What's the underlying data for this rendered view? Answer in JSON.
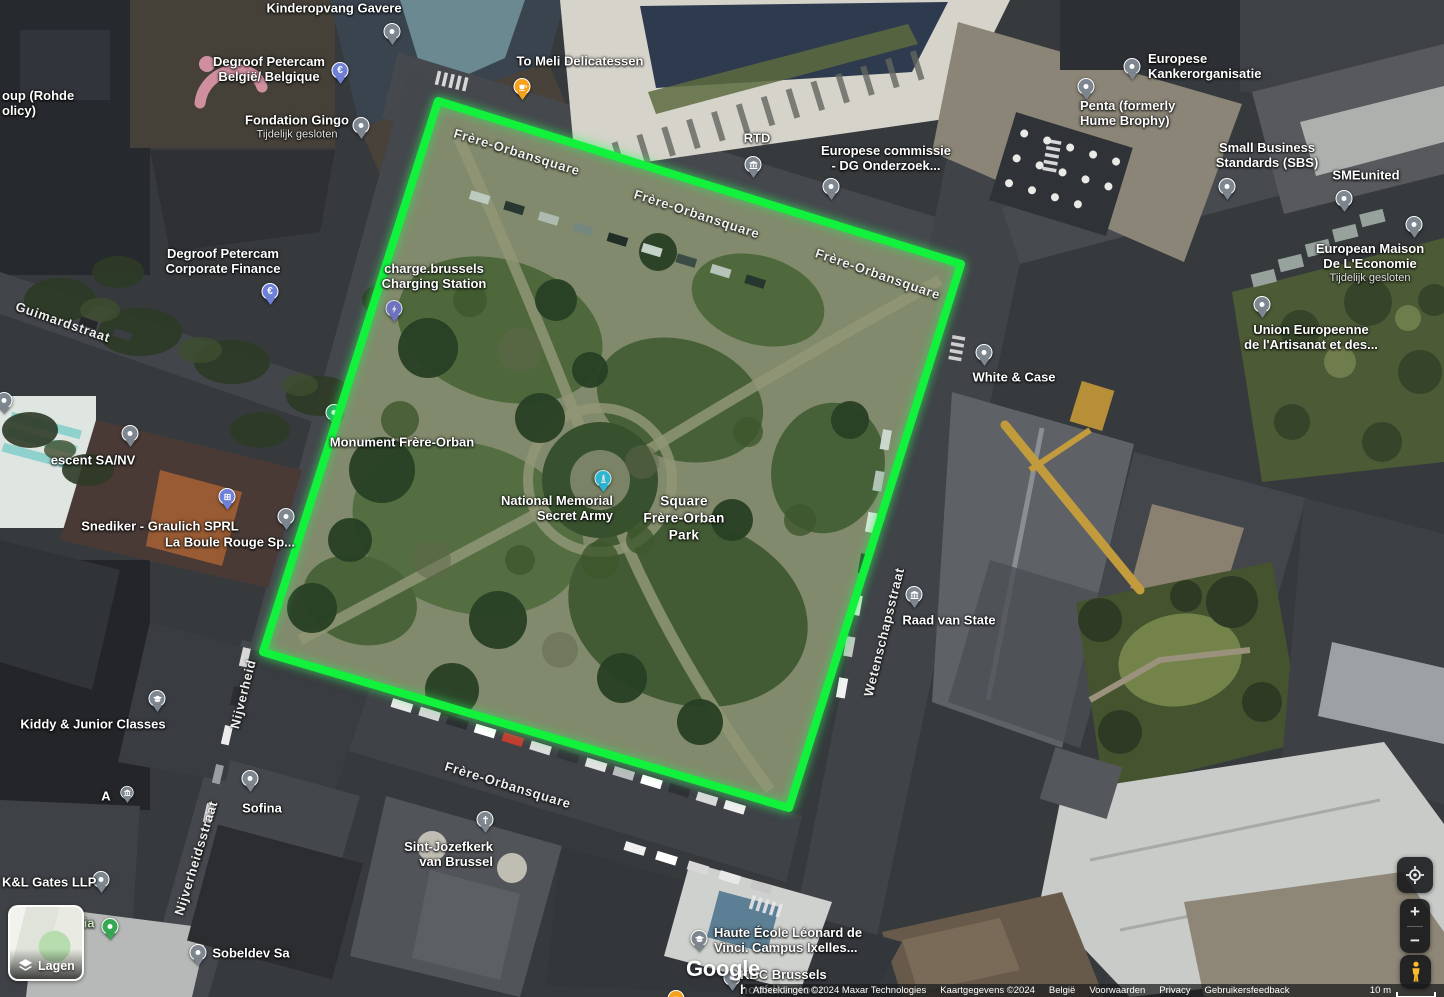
{
  "brand": "Google",
  "green_area": {
    "stroke": "#12f13c",
    "points": [
      [
        438,
        101
      ],
      [
        961,
        264
      ],
      [
        789,
        808
      ],
      [
        263,
        652
      ]
    ]
  },
  "pin_colors": {
    "dot": "#7E8790",
    "bank": "#7E8790",
    "gov": "#7E8790",
    "education": "#7E8790",
    "church": "#7E8790",
    "euro": "#6F80D8",
    "store": "#6F80D8",
    "charging": "#8174DE",
    "memorial": "#35C3F1",
    "monument": "#2AA465",
    "park": "#34A853",
    "food": "#F6A21D"
  },
  "street_labels": [
    {
      "text": "Frère-Orbansquare",
      "x": 517,
      "y": 152,
      "rot": 17
    },
    {
      "text": "Frère-Orbansquare",
      "x": 697,
      "y": 214,
      "rot": 18
    },
    {
      "text": "Frère-Orbansquare",
      "x": 878,
      "y": 274,
      "rot": 19
    },
    {
      "text": "Frère-Orbansquare",
      "x": 508,
      "y": 785,
      "rot": 17
    },
    {
      "text": "Guimardstraat",
      "x": 63,
      "y": 322,
      "rot": 19
    },
    {
      "text": "Wetenschapsstraat",
      "x": 884,
      "y": 632,
      "rot": -76
    },
    {
      "text": "Nijverheid",
      "x": 243,
      "y": 694,
      "rot": -76
    },
    {
      "text": "Nijverheidsstraat",
      "x": 196,
      "y": 858,
      "rot": -73
    }
  ],
  "markers": [
    {
      "id": "kinderopvang-gavere",
      "type": "dot",
      "x": 392,
      "y": 45,
      "lines": [
        "Kinderopvang Gavere"
      ],
      "lx": 334,
      "ly": 9,
      "align": "center"
    },
    {
      "id": "degroof-petercam-belgie",
      "type": "euro",
      "x": 340,
      "y": 84,
      "lines": [
        "Degroof Petercam",
        "België/ Belgique"
      ],
      "lx": 269,
      "ly": 70,
      "align": "center"
    },
    {
      "id": "fondation-gingo",
      "type": "dot",
      "x": 361,
      "y": 139,
      "lines": [
        "Fondation Gingo"
      ],
      "sub": "Tijdelijk gesloten",
      "lx": 297,
      "ly": 127,
      "align": "center"
    },
    {
      "id": "rohde-partial",
      "type": "none",
      "lines": [
        "oup (Rohde",
        "olicy)"
      ],
      "lx": 2,
      "ly": 104,
      "align": "left"
    },
    {
      "id": "degroof-petercam-corporate",
      "type": "euro",
      "x": 270,
      "y": 305,
      "lines": [
        "Degroof Petercam",
        "Corporate Finance"
      ],
      "lx": 223,
      "ly": 262,
      "align": "center"
    },
    {
      "id": "to-meli-delicatessen",
      "type": "food",
      "x": 522,
      "y": 100,
      "lines": [
        "To Meli Delicatessen"
      ],
      "lx": 580,
      "ly": 62,
      "align": "center"
    },
    {
      "id": "rtd",
      "type": "bank",
      "x": 753,
      "y": 178,
      "lines": [
        "RTD"
      ],
      "lx": 757,
      "ly": 139,
      "align": "center"
    },
    {
      "id": "europese-commissie",
      "type": "dot",
      "x": 831,
      "y": 200,
      "lines": [
        "Europese commissie",
        "- DG Onderzoek..."
      ],
      "lx": 886,
      "ly": 159,
      "align": "center"
    },
    {
      "id": "europese-kankerorganisatie",
      "type": "dot",
      "x": 1132,
      "y": 80,
      "lines": [
        "Europese",
        "Kankerorganisatie"
      ],
      "lx": 1148,
      "ly": 67,
      "align": "left"
    },
    {
      "id": "penta-hume-brophy",
      "type": "dot",
      "x": 1086,
      "y": 100,
      "lines": [
        "Penta (formerly",
        "Hume Brophy)"
      ],
      "lx": 1080,
      "ly": 114,
      "align": "left"
    },
    {
      "id": "small-business-standards",
      "type": "dot",
      "x": 1227,
      "y": 200,
      "lines": [
        "Small Business",
        "Standards (SBS)"
      ],
      "lx": 1267,
      "ly": 156,
      "align": "center"
    },
    {
      "id": "smeunited",
      "type": "dot",
      "x": 1344,
      "y": 212,
      "lines": [
        "SMEunited"
      ],
      "lx": 1366,
      "ly": 176,
      "align": "center"
    },
    {
      "id": "european-maison-economie",
      "type": "dot",
      "x": 1414,
      "y": 238,
      "lines": [
        "European Maison",
        "De L'Economie"
      ],
      "sub": "Tijdelijk gesloten",
      "lx": 1370,
      "ly": 263,
      "align": "center"
    },
    {
      "id": "union-europeenne-artisanat",
      "type": "dot",
      "x": 1262,
      "y": 318,
      "lines": [
        "Union Europeenne",
        "de l'Artisanat et des..."
      ],
      "lx": 1311,
      "ly": 338,
      "align": "center"
    },
    {
      "id": "charge-brussels",
      "type": "charging",
      "x": 394,
      "y": 322,
      "lines": [
        "charge.brussels",
        "Charging Station"
      ],
      "lx": 434,
      "ly": 277,
      "align": "center"
    },
    {
      "id": "monument-frere-orban",
      "type": "monument",
      "x": 334,
      "y": 426,
      "lines": [
        "Monument Frère-Orban"
      ],
      "lx": 402,
      "ly": 443,
      "align": "center"
    },
    {
      "id": "crescent-sa-nv",
      "type": "dot",
      "x": 130,
      "y": 447,
      "lines": [
        "escent SA/NV"
      ],
      "lx": 93,
      "ly": 461,
      "align": "center"
    },
    {
      "id": "snediker-graulich",
      "type": "store",
      "x": 227,
      "y": 510,
      "lines": [
        "Snediker - Graulich SPRL"
      ],
      "lx": 160,
      "ly": 527,
      "align": "center"
    },
    {
      "id": "la-boule-rouge",
      "type": "dot",
      "x": 286,
      "y": 530,
      "lines": [
        "La Boule Rouge Sp..."
      ],
      "lx": 230,
      "ly": 543,
      "align": "center"
    },
    {
      "id": "national-memorial-secret-army",
      "type": "memorial",
      "x": 603,
      "y": 492,
      "lines": [
        "National Memorial",
        "Secret Army"
      ],
      "lx": 613,
      "ly": 509,
      "align": "right"
    },
    {
      "id": "square-frere-orban-park",
      "type": "none",
      "kind": "area",
      "lines": [
        "Square",
        "Frère-Orban",
        "Park"
      ],
      "lx": 684,
      "ly": 519,
      "align": "center"
    },
    {
      "id": "white-and-case",
      "type": "dot",
      "x": 984,
      "y": 366,
      "lines": [
        "White & Case"
      ],
      "lx": 1014,
      "ly": 378,
      "align": "center"
    },
    {
      "id": "raad-van-state",
      "type": "gov",
      "x": 914,
      "y": 608,
      "lines": [
        "Raad van State"
      ],
      "lx": 949,
      "ly": 621,
      "align": "center"
    },
    {
      "id": "kiddy-junior-classes",
      "type": "education",
      "x": 157,
      "y": 712,
      "lines": [
        "Kiddy & Junior Classes"
      ],
      "lx": 93,
      "ly": 725,
      "align": "center"
    },
    {
      "id": "gov-a",
      "type": "gov",
      "small": true,
      "x": 127,
      "y": 803,
      "lines": [
        "A"
      ],
      "lx": 106,
      "ly": 797,
      "align": "center"
    },
    {
      "id": "kl-gates-llp",
      "type": "dot",
      "x": 101,
      "y": 893,
      "lines": [
        "K&L Gates LLP"
      ],
      "lx": 2,
      "ly": 883,
      "align": "left"
    },
    {
      "id": "green-ia",
      "type": "park",
      "x": 110,
      "y": 940,
      "lines": [
        "ia"
      ],
      "lx": 89,
      "ly": 924,
      "align": "center",
      "lcolor": "#cde9c0"
    },
    {
      "id": "sofina",
      "type": "dot",
      "x": 250,
      "y": 792,
      "lines": [
        "Sofina"
      ],
      "lx": 262,
      "ly": 809,
      "align": "center"
    },
    {
      "id": "sobeldev-sa",
      "type": "dot",
      "x": 198,
      "y": 966,
      "lines": [
        "Sobeldev Sa"
      ],
      "lx": 251,
      "ly": 954,
      "align": "center"
    },
    {
      "id": "sint-jozefkerk",
      "type": "church",
      "x": 485,
      "y": 833,
      "lines": [
        "Sint-Jozefkerk",
        "van Brussel"
      ],
      "lx": 493,
      "ly": 855,
      "align": "right"
    },
    {
      "id": "haute-ecole-leonard",
      "type": "education",
      "x": 699,
      "y": 952,
      "lines": [
        "Haute École Léonard de",
        "Vinci. Campus Ixelles..."
      ],
      "lx": 714,
      "ly": 941,
      "align": "left"
    },
    {
      "id": "kbc-brussels",
      "type": "dot",
      "x": 732,
      "y": 991,
      "lines": [
        "KBC Brussels",
        "hoofdkantoor"
      ],
      "lx": 740,
      "ly": 983,
      "align": "left"
    },
    {
      "id": "orange-pin-partial",
      "type": "food",
      "x": 676,
      "y": 1012,
      "lines": []
    },
    {
      "id": "edge-pin-left",
      "type": "dot",
      "x": 4,
      "y": 414,
      "lines": []
    }
  ],
  "controls": {
    "layers": "Lagen",
    "zoom_in": "+",
    "zoom_out": "−"
  },
  "attribution": {
    "imagery": "Afbeeldingen ©2024 Maxar Technologies",
    "map_data": "Kaartgegevens ©2024",
    "links": [
      "België",
      "Voorwaarden",
      "Privacy",
      "Gebruikersfeedback"
    ],
    "scale": "10 m"
  }
}
